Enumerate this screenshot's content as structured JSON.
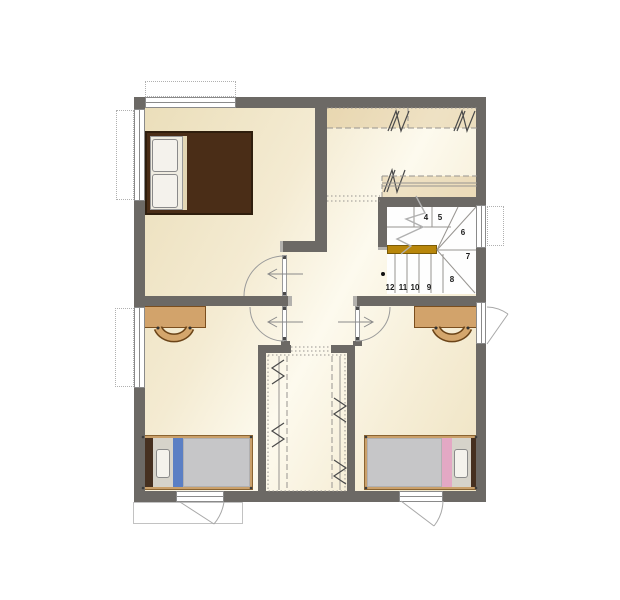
{
  "floor_plan": {
    "description": "second floor residential plan",
    "stairs": {
      "steps": [
        {
          "label": "4"
        },
        {
          "label": "5"
        },
        {
          "label": "6"
        },
        {
          "label": "7"
        },
        {
          "label": "8"
        },
        {
          "label": "9"
        },
        {
          "label": "10"
        },
        {
          "label": "11"
        },
        {
          "label": "12"
        }
      ]
    },
    "palette": {
      "wall": "#6c6965",
      "floor_light": "#fdfaee",
      "floor_shade": "#eaddb8",
      "stair_landing_accent": "#b8860b",
      "master_bed_brown": "#4a2d17",
      "bed_frame_tan": "#caa06a",
      "mattress_gray": "#c6c6c8",
      "bed_accent_blue": "#5b7fc4",
      "bed_accent_pink": "#e3a8c4",
      "desk_wood": "#d2a36b",
      "linework_gray": "#979490"
    }
  }
}
